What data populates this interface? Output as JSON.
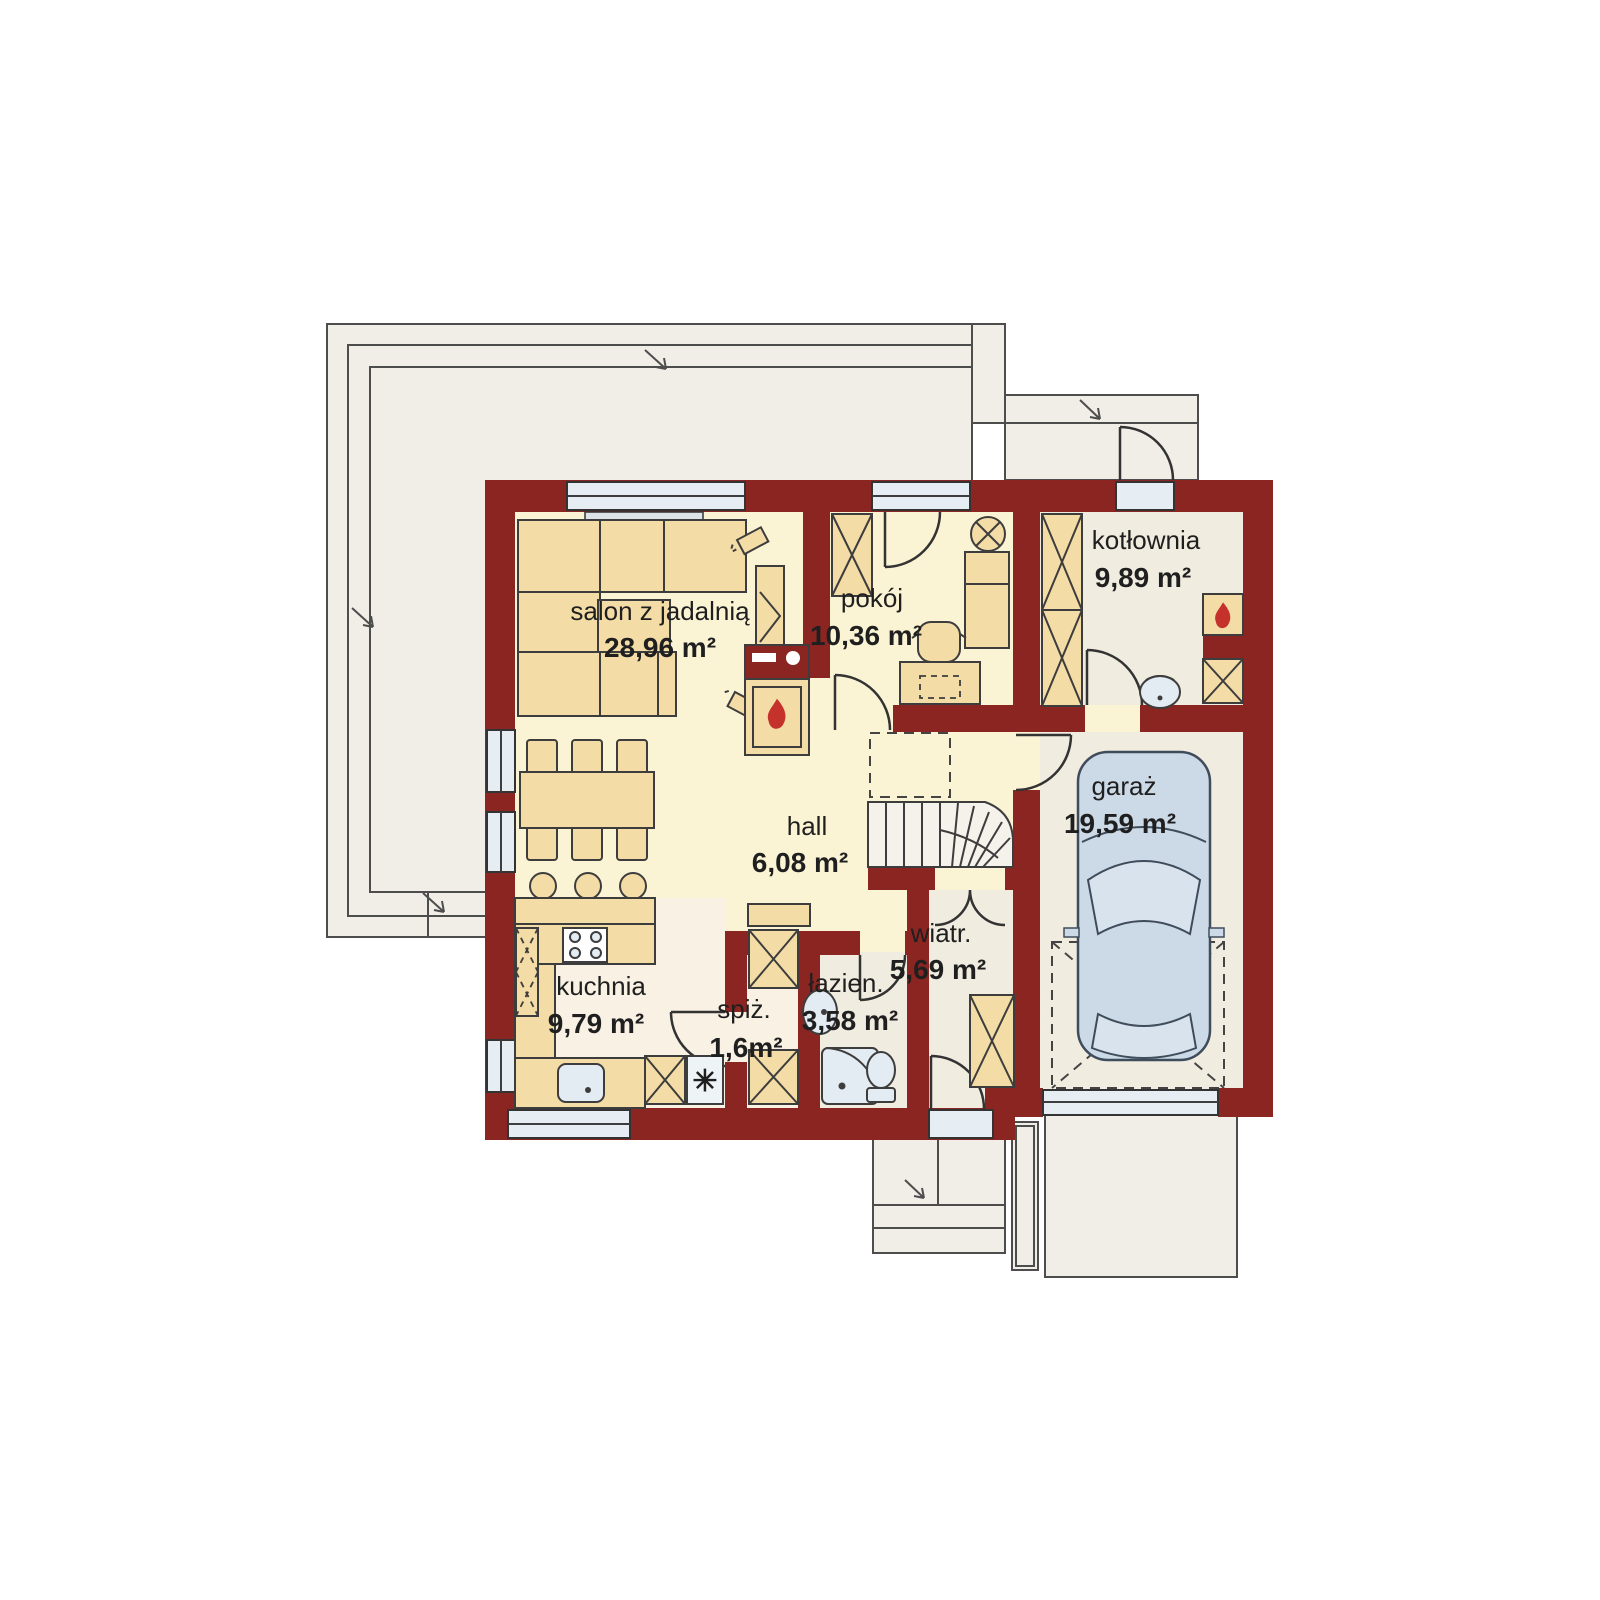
{
  "plan": {
    "type": "house-ground-floor-plan",
    "language": "pl"
  },
  "rooms": [
    {
      "id": "salon",
      "label": "salon z jadalnią",
      "area": "28,96 m²"
    },
    {
      "id": "pokoj",
      "label": "pokój",
      "area": "10,36 m²"
    },
    {
      "id": "kotlownia",
      "label": "kotłownia",
      "area": "9,89 m²"
    },
    {
      "id": "hall",
      "label": "hall",
      "area": "6,08 m²"
    },
    {
      "id": "garaz",
      "label": "garaż",
      "area": "19,59 m²"
    },
    {
      "id": "wiatr",
      "label": "wiatr.",
      "area": "5,69 m²"
    },
    {
      "id": "kuchnia",
      "label": "kuchnia",
      "area": "9,79 m²"
    },
    {
      "id": "spiz",
      "label": "spiż.",
      "area": "1,6m²"
    },
    {
      "id": "lazienka",
      "label": "łazien.",
      "area": "3,58 m²"
    }
  ],
  "glyphs": {
    "freezer": "✳"
  },
  "colors": {
    "wall": "#8b2522",
    "floor_main": "#fbf4d4",
    "floor_utility": "#f1ece0",
    "floor_kitchen": "#f9f1e3",
    "furniture": "#f4dca6",
    "outside": "#f0eee7",
    "glazing": "#e7eef3",
    "fixtures": "#e3ecf3",
    "car": "#ccd9e7",
    "flame": "#c5322c",
    "text": "#1f1f1f"
  }
}
